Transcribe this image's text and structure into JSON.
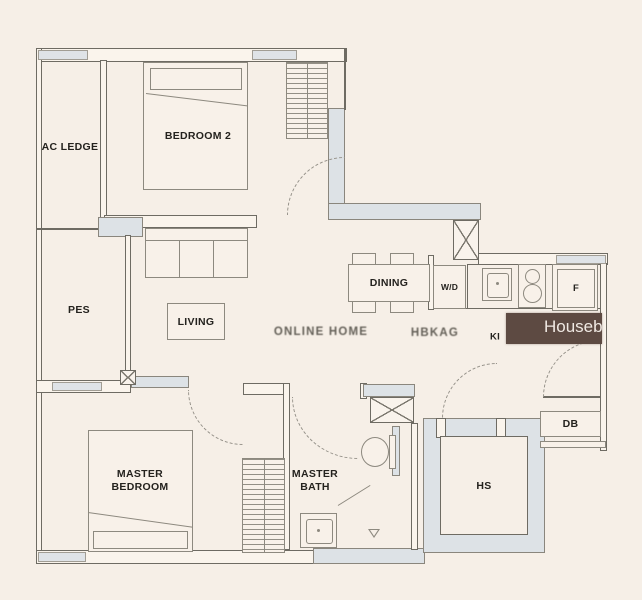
{
  "rooms": {
    "ac_ledge": "AC LEDGE",
    "bedroom2": "BEDROOM 2",
    "pes": "PES",
    "living": "LIVING",
    "dining": "DINING",
    "wd": "W/D",
    "fridge": "F",
    "kitchen": "KI",
    "master_bedroom": "MASTER BEDROOM",
    "master_bath": "MASTER BATH",
    "hs": "HS",
    "db": "DB"
  },
  "watermarks": {
    "center_left": "ONLINE HOME",
    "center_right": "HBKAG",
    "brand": "Housebe"
  },
  "colors": {
    "background": "#f6efe7",
    "wall_fill": "#dde2e6",
    "line": "#6e6b63",
    "label": "#24221e",
    "brand_bg": "#5d4a42",
    "brand_text": "#efe8e2"
  }
}
